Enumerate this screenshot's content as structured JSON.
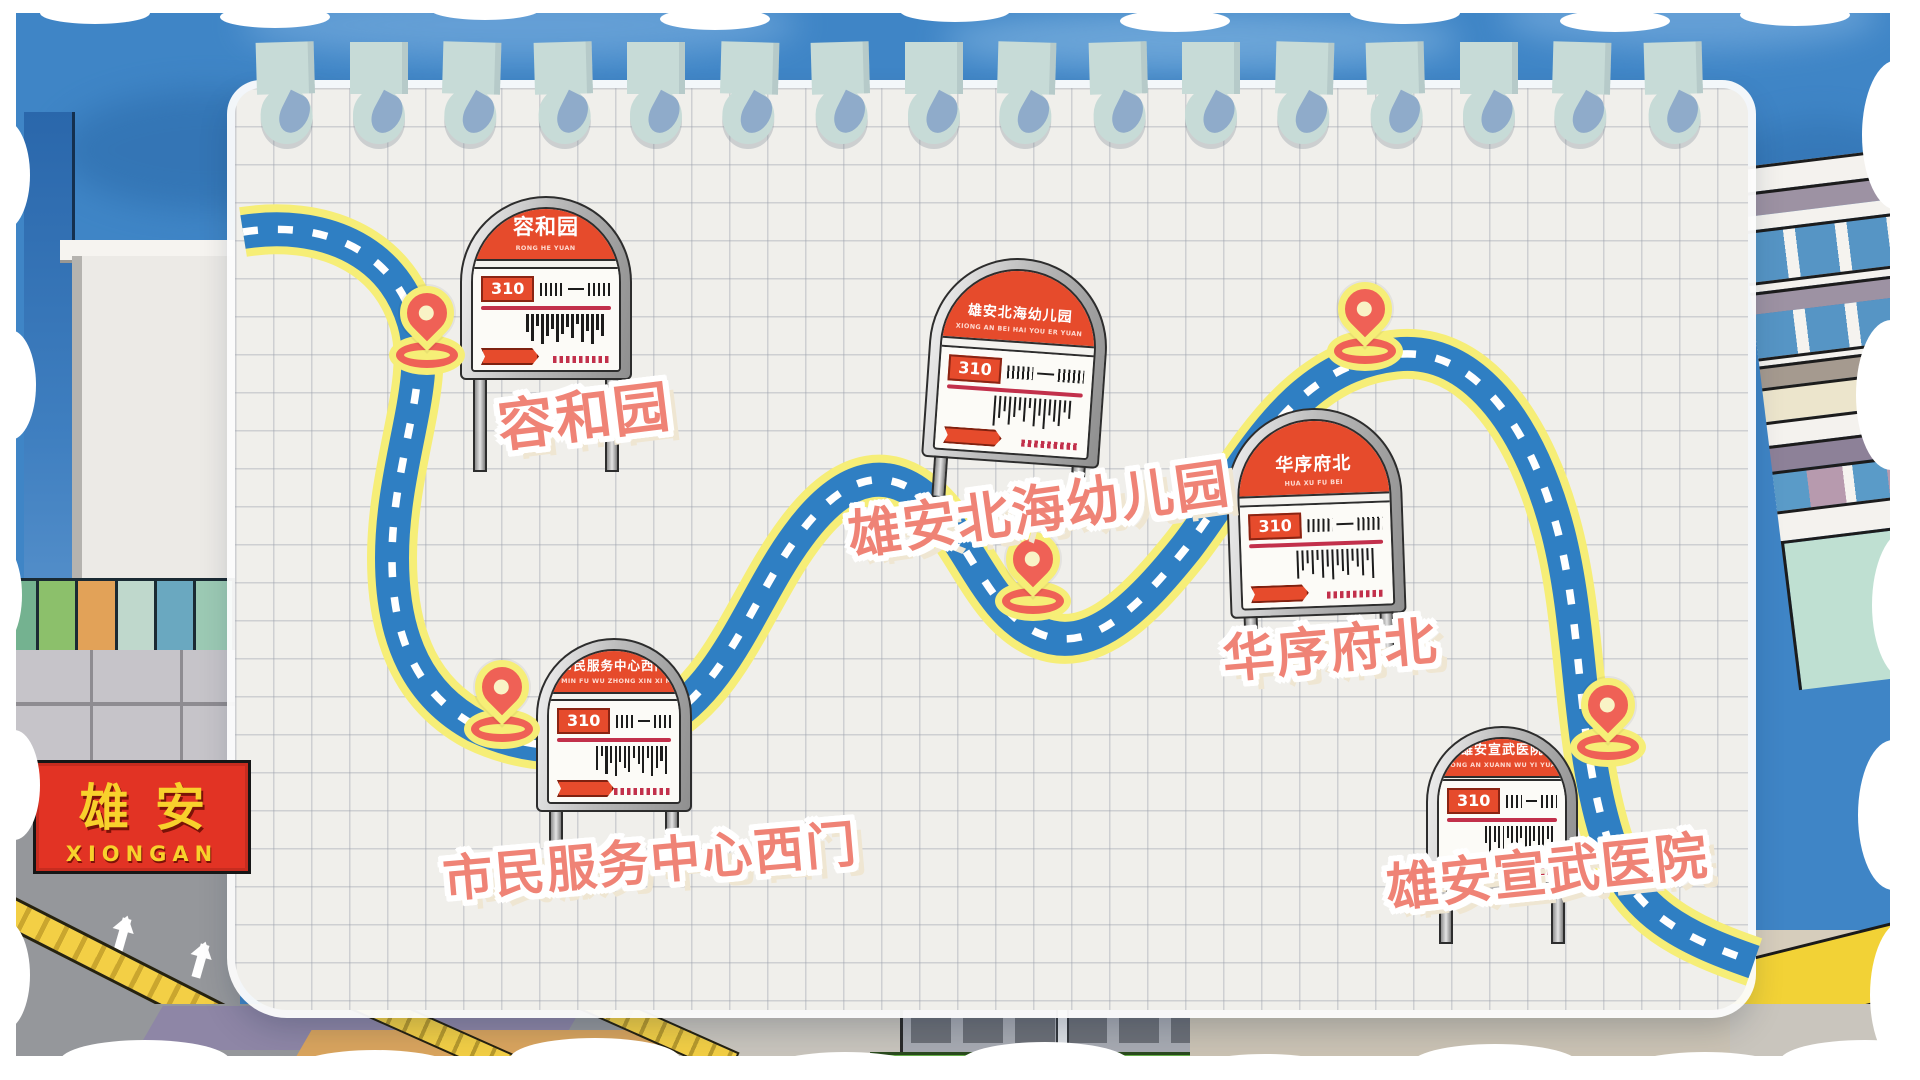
{
  "corner_sign": {
    "cn": "雄安",
    "en": "XIONGAN"
  },
  "route": {
    "number": "310"
  },
  "stops": [
    {
      "name_cn": "容和园",
      "name_en": "RONG HE YUAN",
      "route_no": "310"
    },
    {
      "name_cn": "雄安北海幼儿园",
      "name_en": "XIONG AN BEI HAI YOU ER YUAN",
      "route_no": "310"
    },
    {
      "name_cn": "华序府北",
      "name_en": "HUA XU FU BEI",
      "route_no": "310"
    },
    {
      "name_cn": "市民服务中心西门",
      "name_en": "SHI MIN FU WU ZHONG XIN XI MEN",
      "route_no": "310"
    },
    {
      "name_cn": "雄安宣武医院",
      "name_en": "XIONG AN XUANN WU YI YUAN",
      "route_no": "310"
    }
  ],
  "colors": {
    "route_blue": "#2f7fc3",
    "route_outline_yellow": "#f6ee77",
    "sign_red": "#e64b2c",
    "label_coral": "#ef8376",
    "pin_red": "#ef6156",
    "sky_blue": "#3f85c6",
    "paper": "#f0efeb"
  }
}
